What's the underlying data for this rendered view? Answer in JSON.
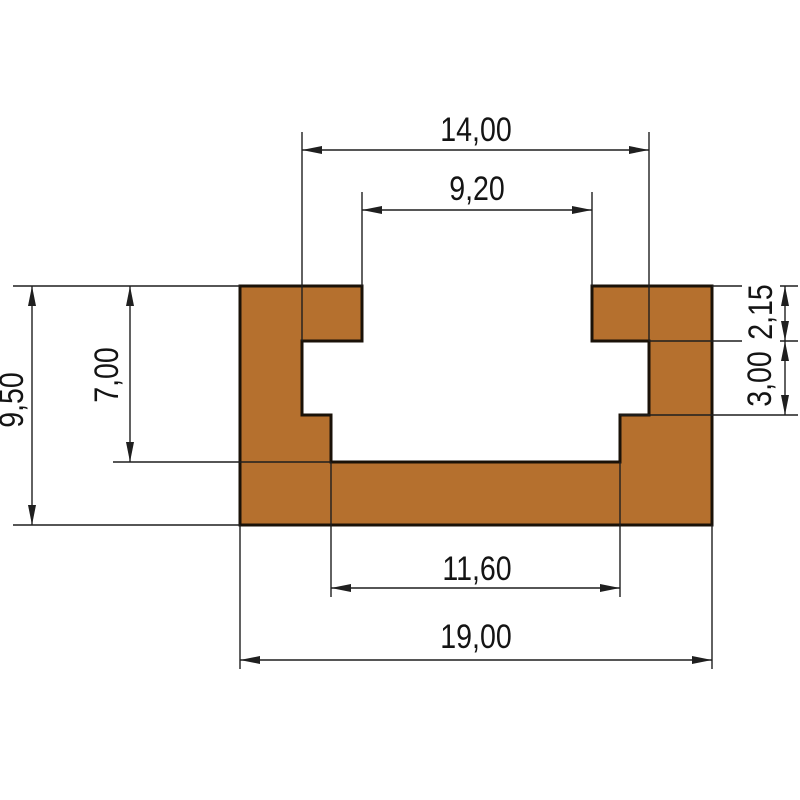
{
  "drawing": {
    "type": "t-slot-track-profile-cross-section",
    "labels": {
      "top_width": "14,00",
      "slot_opening_width": "9,20",
      "inner_bottom_width": "11,60",
      "overall_width": "19,00",
      "overall_height": "9,50",
      "slot_depth": "7,00",
      "lip_thickness": "2,15",
      "undercut_height": "3,00"
    },
    "colors": {
      "profile_fill": "#b5702e",
      "profile_outline": "#1a1208",
      "line_color": "#1f1f1f"
    }
  }
}
